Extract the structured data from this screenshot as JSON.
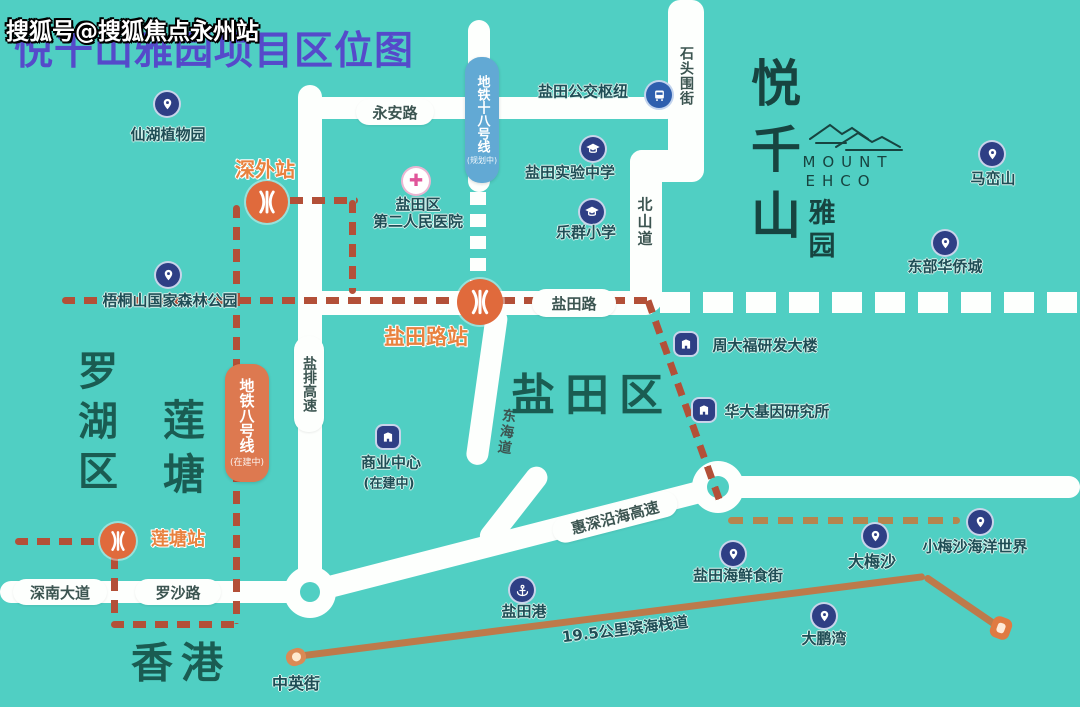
{
  "watermark": "搜狐号@搜狐焦点永州站",
  "title": "悦千山雅园项目区位图",
  "logo": {
    "name": "悦千山",
    "english": [
      "MOUNT",
      "EHCO"
    ],
    "subtitle": "雅园"
  },
  "districts": {
    "luohu": "罗湖区",
    "liantang": "莲塘",
    "yantian": "盐田区",
    "hongkong": "香港"
  },
  "roads": {
    "yongan": "永安路",
    "yantian_rd": "盐田路",
    "beishan": "北山道",
    "shitouwei": "石头围街",
    "donghai": "东海道",
    "yanpai": "盐排高速",
    "huishen": "惠深沿海高速",
    "shennan": "深南大道",
    "luosha": "罗沙路"
  },
  "metro": {
    "line18": {
      "name": "地铁十八号线",
      "status": "(规划中)"
    },
    "line8": {
      "name": "地铁八号线",
      "status": "(在建中)"
    },
    "stations": {
      "shenwai": "深外站",
      "yantianlu": "盐田路站",
      "liantang": "莲塘站"
    }
  },
  "pois": {
    "xianhu": "仙湖植物园",
    "wutongshan": "梧桐山国家森林公园",
    "maluanshan": "马峦山",
    "dongbu": "东部华侨城",
    "shiyan": "盐田实验中学",
    "lequn": "乐群小学",
    "hospital": {
      "line1": "盐田区",
      "line2": "第二人民医院"
    },
    "bus_hub": "盐田公交枢纽",
    "shangye": {
      "label": "商业中心",
      "status": "(在建中)"
    },
    "zhoudafu": "周大福研发大楼",
    "huada": "华大基因研究所",
    "yantian_port": "盐田港",
    "seafood": "盐田海鲜食街",
    "dameisha": "大梅沙",
    "xiaomeisha": "小梅沙海洋世界",
    "dapengwan": "大鹏湾",
    "zhongying": "中英街"
  },
  "boardwalk": {
    "label": "19.5公里滨海栈道"
  },
  "colors": {
    "background": "#50cfc3",
    "road": "#fdfffd",
    "metro_dash": "#b35038",
    "boardwalk": "#bd7a4b",
    "line18_bg": "#62a9d4",
    "line8_bg": "#dd7950",
    "station_text": "#e8823f",
    "poi_icon": "#2e3f85",
    "district_text": "#1a5c52",
    "title_text": "#5633cc",
    "hospital_cross": "#e0559a",
    "bus_icon_bg": "#2e5fae"
  }
}
